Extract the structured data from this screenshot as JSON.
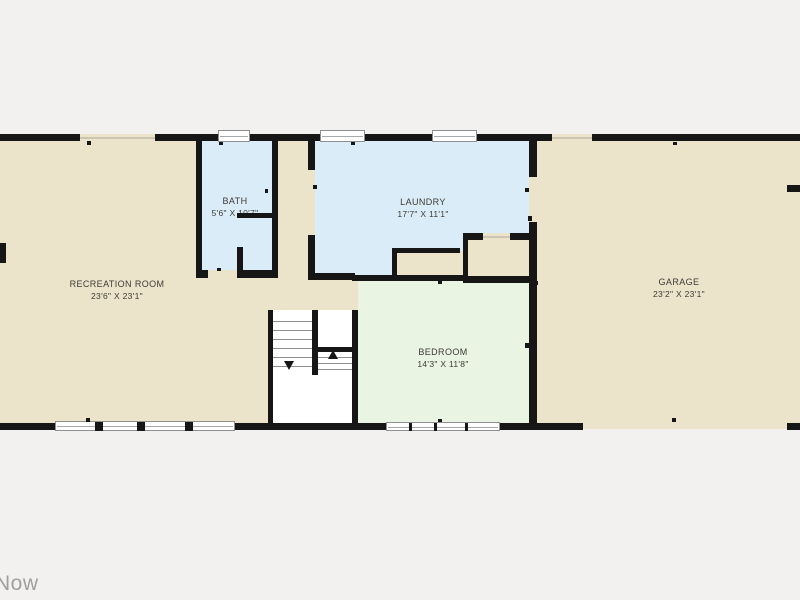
{
  "watermark": {
    "text": "Now"
  },
  "rooms": {
    "recreation": {
      "name": "RECREATION ROOM",
      "dims": "23'6\" X 23'1\""
    },
    "bath": {
      "name": "BATH",
      "dims": "5'6\" X 10'7\""
    },
    "laundry": {
      "name": "LAUNDRY",
      "dims": "17'7\" X 11'1\""
    },
    "bedroom": {
      "name": "BEDROOM",
      "dims": "14'3\" X 11'8\""
    },
    "garage": {
      "name": "GARAGE",
      "dims": "23'2\" X 23'1\""
    }
  },
  "colors": {
    "bg": "#f3f1ef",
    "floor": "#ebe4cb",
    "wet": "#daecf7",
    "bed": "#e9f4e3",
    "wall": "#161616",
    "text": "#3e3a35",
    "watermark": "#9f9f9f"
  }
}
